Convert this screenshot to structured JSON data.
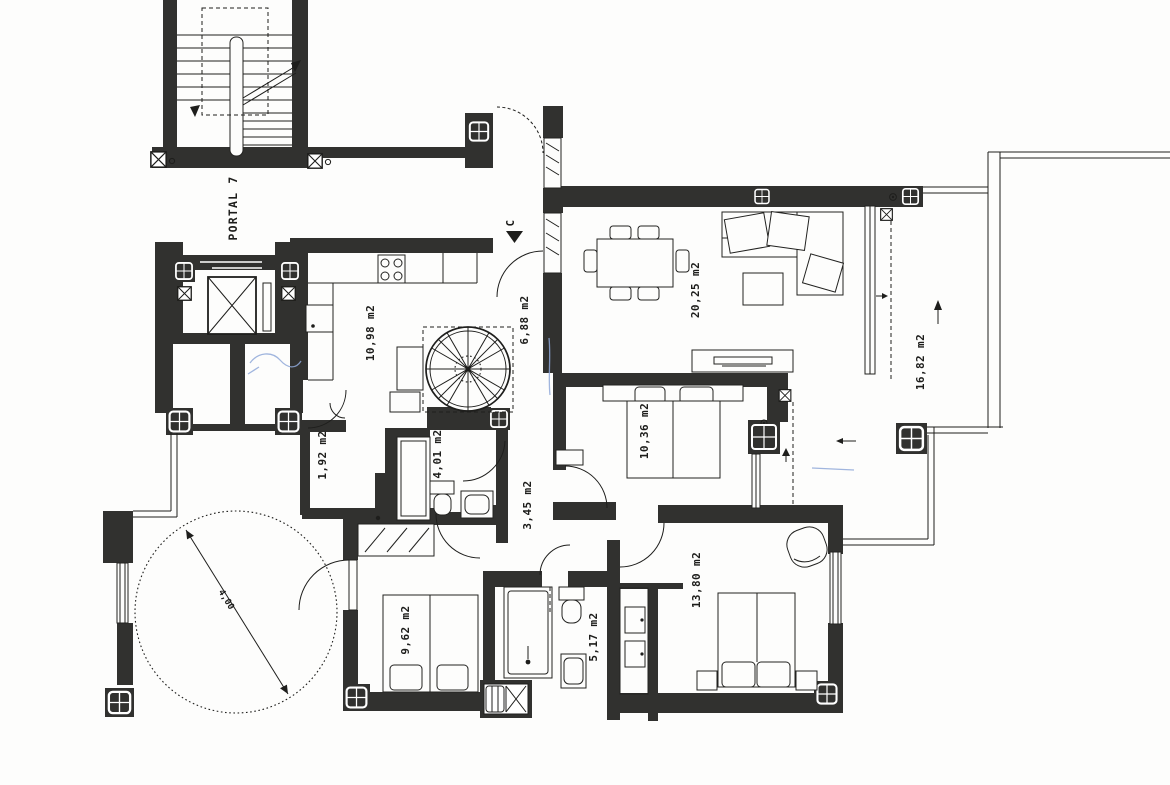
{
  "document": {
    "type": "apartment-floor-plan",
    "colors": {
      "wall": "#31312f",
      "line": "#1e1e1c",
      "paper": "#fdfdfc",
      "pen_annotation": "#8fa8d8"
    }
  },
  "labels": {
    "portal": "PORTAL 7",
    "entrance_unit": "C",
    "turret_diameter": "4,00",
    "kitchen": "10,98 m2",
    "hall": "6,88 m2",
    "living_room": "20,25 m2",
    "terrace": "16,82 m2",
    "bedroom_2": "10,36 m2",
    "laundry": "1,92 m2",
    "bathroom_1": "4,01 m2",
    "corridor": "3,45 m2",
    "bedroom_master": "13,80 m2",
    "bedroom_3": "9,62 m2",
    "bathroom_2": "5,17 m2"
  }
}
